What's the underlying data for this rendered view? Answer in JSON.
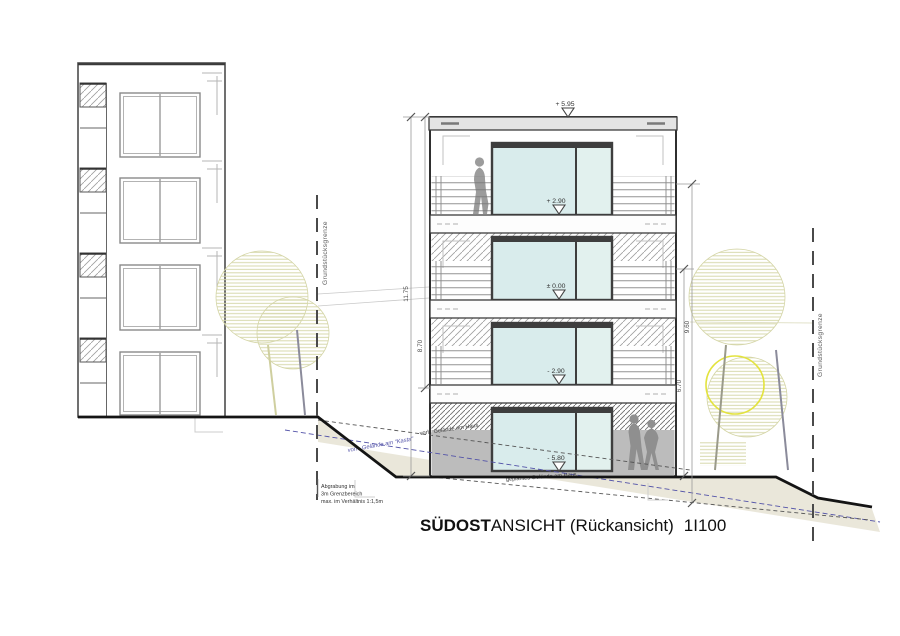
{
  "drawing": {
    "title": {
      "bold": "SÜDOST",
      "rest": "ANSICHT (Rückansicht)",
      "scale": "1I100"
    },
    "levels": {
      "roof": "+ 5.95",
      "f1": "+ 2.90",
      "f0": "± 0.00",
      "b1": "- 2.90",
      "b2": "- 5.80"
    },
    "dimensions": {
      "total": "11.75",
      "upper": "8.70",
      "right_outer": "9.60",
      "right_inner": "6.70"
    },
    "boundary": {
      "left": "Grundstücksgrenze",
      "right": "Grundstücksgrenze"
    },
    "terrain": {
      "existing_house": "vorh. Gelände am Haus",
      "existing_kasta": "vorh. Gelände am \"Kasta\"",
      "planned_house": "geplantes Gelände am Haus"
    },
    "note": {
      "line1": "Abgrabung im",
      "line2": "3m Grenzbereich",
      "line3": "max. im Verhältnis 1:1,5m"
    },
    "colors": {
      "glass": "#d9ecec",
      "terrain_fill": "#e8e4d6",
      "tree_hatch": "#d7d8ac",
      "boundary_blue": "#5353a8",
      "accent_yellow": "#e3e33e"
    }
  }
}
